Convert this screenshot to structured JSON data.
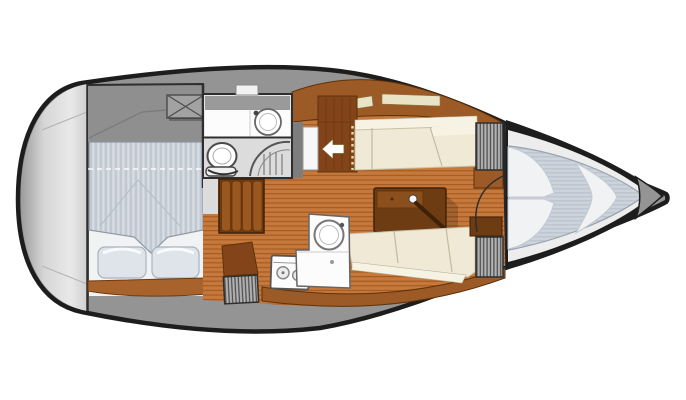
{
  "meta": {
    "diagram_type": "sailboat-interior-floor-plan",
    "orientation": "bow-right"
  },
  "colors": {
    "hull_outline": "#1d1d1d",
    "deck_gray": "#949494",
    "deck_dark": "#8f8f8f",
    "stern_light": "#e6e6e6",
    "wall": "#2e2e2e",
    "floor_wood": "#c6793c",
    "floor_wood_line": "#a4581f",
    "wood_band": "#9c5b26",
    "wood_dark": "#83441a",
    "cabinet_base": "#6f3c12",
    "cabinet_slat": "#9a571f",
    "wood_step": "#a8632d",
    "table_dark": "#6e3c12",
    "table_light": "#8a4f1d",
    "cushion": "#efe9d5",
    "cushion_highlight": "#f7f3e4",
    "mattress": "#cdd3db",
    "mattress_stripe": "#b8c1cc",
    "pillow": "#dfe4eb",
    "linen": "#f1f2f4",
    "fixture_white": "#fcfcfc",
    "head_room": "#e7e7e7",
    "head_floor": "#dcdcdc",
    "locker_gray": "#b2b2b2",
    "locker_stripe": "#4f4f4f",
    "window_slot": "#e9e4c6",
    "hatch_gray": "#a2a2a2",
    "arrow": "#ffffff"
  },
  "elements": {
    "stern_deck": "stern deck",
    "aft_cabin": "aft double-berth cabin",
    "deck_hatch": "deck hatch",
    "head": "head with washbasin, toilet and shower",
    "companionway": "companionway entrance with arrow",
    "galley": "galley with two-burner stove and round sink",
    "salon": "salon with settees and table",
    "forward_cabin": "V-berth forward cabin",
    "anchor_locker": "anchor locker at bow",
    "hanging_lockers": "slatted hanging lockers"
  }
}
